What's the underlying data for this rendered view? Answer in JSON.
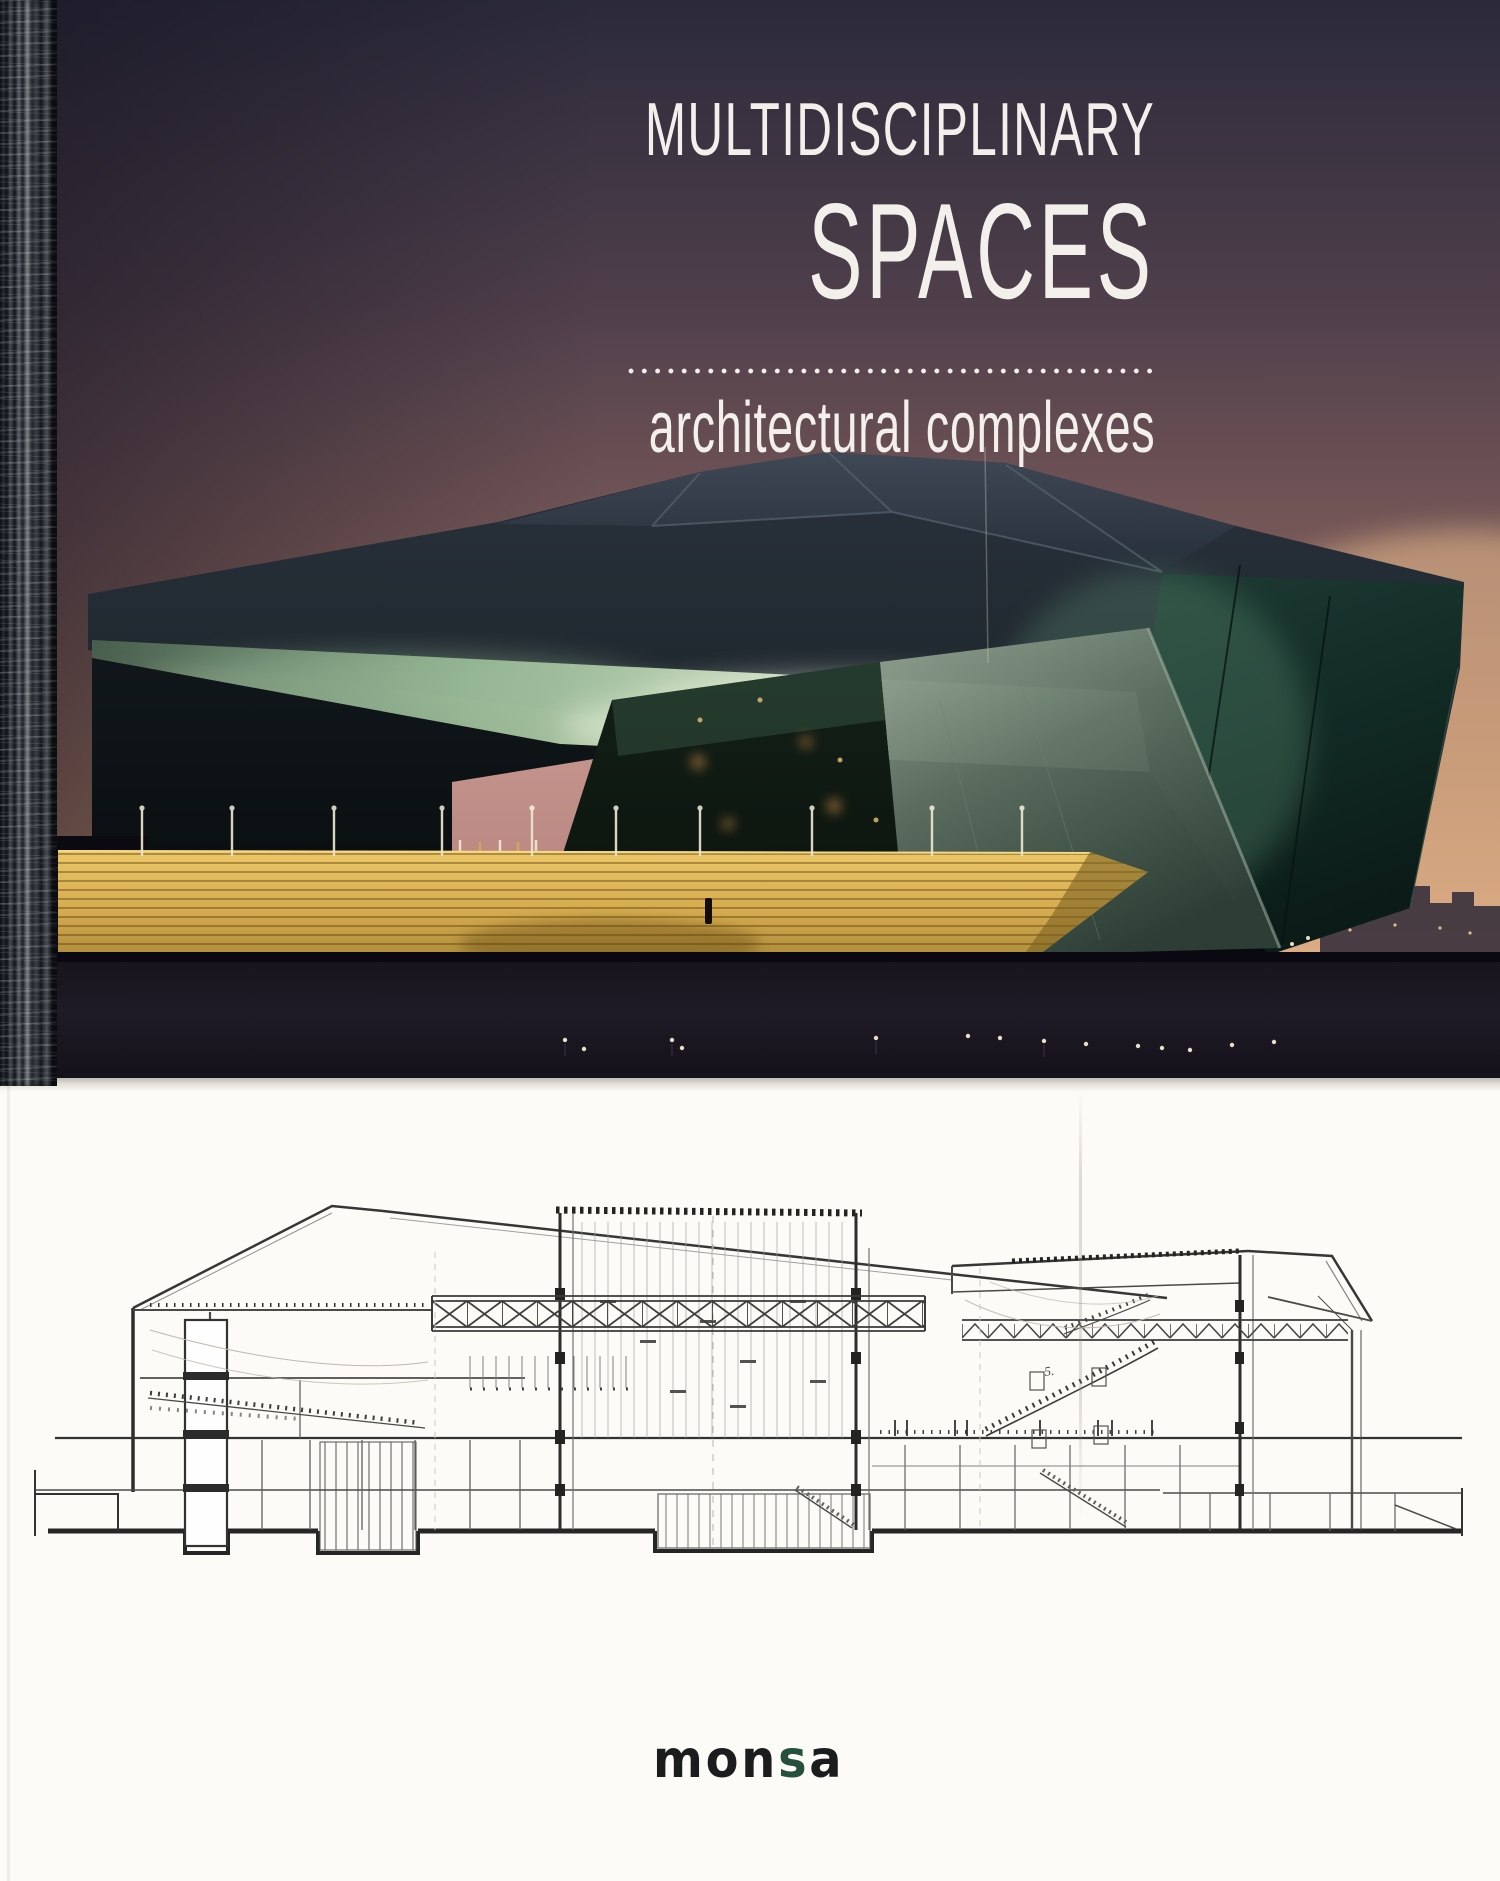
{
  "book_cover": {
    "title_line1": "MULTIDISCIPLINARY",
    "title_line2": "SPACES",
    "subtitle": "architectural complexes",
    "publisher_logo": {
      "part1": "mon",
      "accent": "s",
      "part2": "a"
    },
    "drawing_annotation": "5.",
    "colors": {
      "sky_top": "#2b2a3a",
      "sky_horizon": "#d8a87e",
      "canopy_dark": "#1c2a2c",
      "facade_teal": "#16332c",
      "glow_green": "#cfe3c2",
      "opening_pink": "#c89391",
      "stairs_gold": "#d8b05a",
      "plaza_dark": "#161219",
      "title_text": "#f3f0ec",
      "logo_black": "#1b1c1e",
      "logo_green": "#24503c",
      "paper": "#fcfbf7",
      "drawing_ink": "#3a3a3a"
    }
  }
}
